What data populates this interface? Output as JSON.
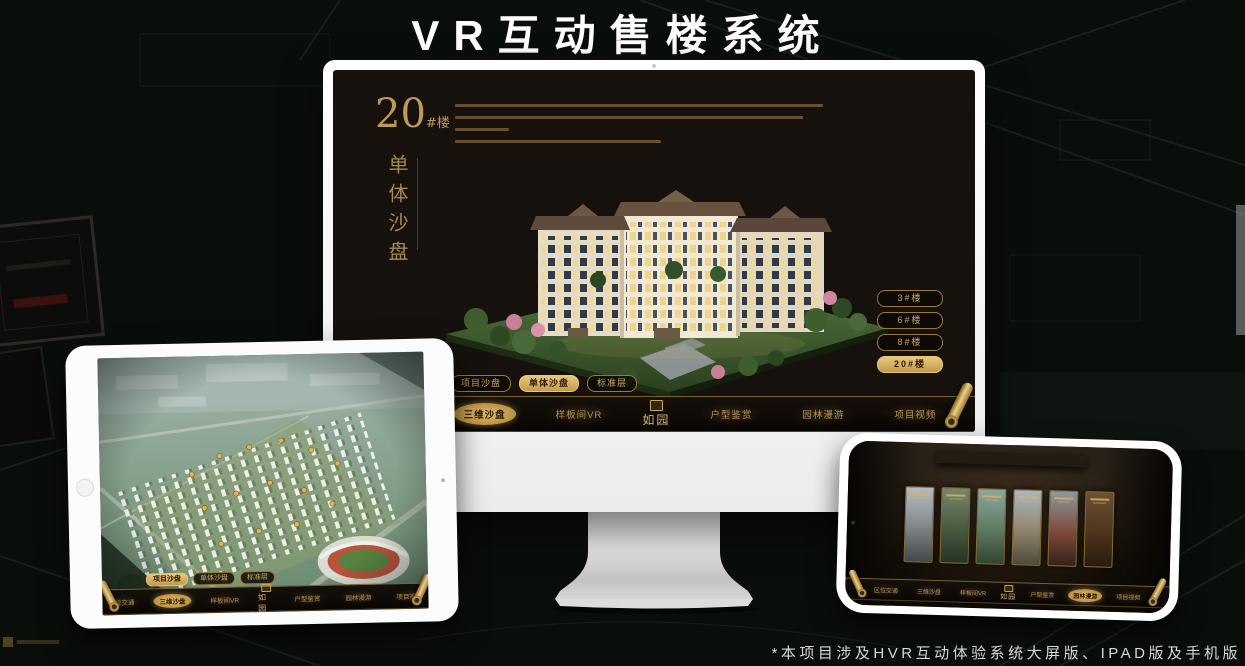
{
  "header": {
    "title": "VR互动售楼系统"
  },
  "footer": {
    "note": "*本项目涉及HVR互动体验系统大屏版、IPAD版及手机版"
  },
  "colors": {
    "gold": "#c8a45e",
    "gold_dark": "#7a6030",
    "screen_bg": "#16110c",
    "page_bg": "#080b08",
    "active_text": "#241806"
  },
  "desktop": {
    "building_no": "20",
    "building_no_suffix": "#楼",
    "building_subtitle": "单体沙盘",
    "floor_buttons": [
      {
        "label": "3#楼",
        "active": false
      },
      {
        "label": "6#楼",
        "active": false
      },
      {
        "label": "8#楼",
        "active": false
      },
      {
        "label": "20#楼",
        "active": true
      }
    ],
    "sub_tabs": [
      {
        "label": "项目沙盘",
        "active": false
      },
      {
        "label": "单体沙盘",
        "active": true
      },
      {
        "label": "标准层",
        "active": false
      }
    ],
    "menu": {
      "logo": "如园",
      "items": [
        {
          "label": "区位交通",
          "active": false
        },
        {
          "label": "三维沙盘",
          "active": true
        },
        {
          "label": "样板间VR",
          "active": false
        },
        {
          "label": "户型鉴赏",
          "active": false
        },
        {
          "label": "园林漫游",
          "active": false
        },
        {
          "label": "项目视频",
          "active": false
        }
      ]
    }
  },
  "tablet": {
    "sub_tabs": [
      {
        "label": "项目沙盘",
        "active": true
      },
      {
        "label": "单体沙盘",
        "active": false
      },
      {
        "label": "标准层",
        "active": false
      }
    ],
    "menu": {
      "logo": "如园",
      "items": [
        {
          "label": "区位交通",
          "active": false
        },
        {
          "label": "三维沙盘",
          "active": true
        },
        {
          "label": "样板间VR",
          "active": false
        },
        {
          "label": "户型鉴赏",
          "active": false
        },
        {
          "label": "园林漫游",
          "active": false
        },
        {
          "label": "项目视频",
          "active": false
        }
      ]
    }
  },
  "phone": {
    "menu": {
      "logo": "如园",
      "items": [
        {
          "label": "区位交通",
          "active": false
        },
        {
          "label": "三维沙盘",
          "active": false
        },
        {
          "label": "样板间VR",
          "active": false
        },
        {
          "label": "户型鉴赏",
          "active": false
        },
        {
          "label": "园林漫游",
          "active": true
        },
        {
          "label": "项目视频",
          "active": false
        }
      ]
    },
    "gallery_count": "6"
  }
}
